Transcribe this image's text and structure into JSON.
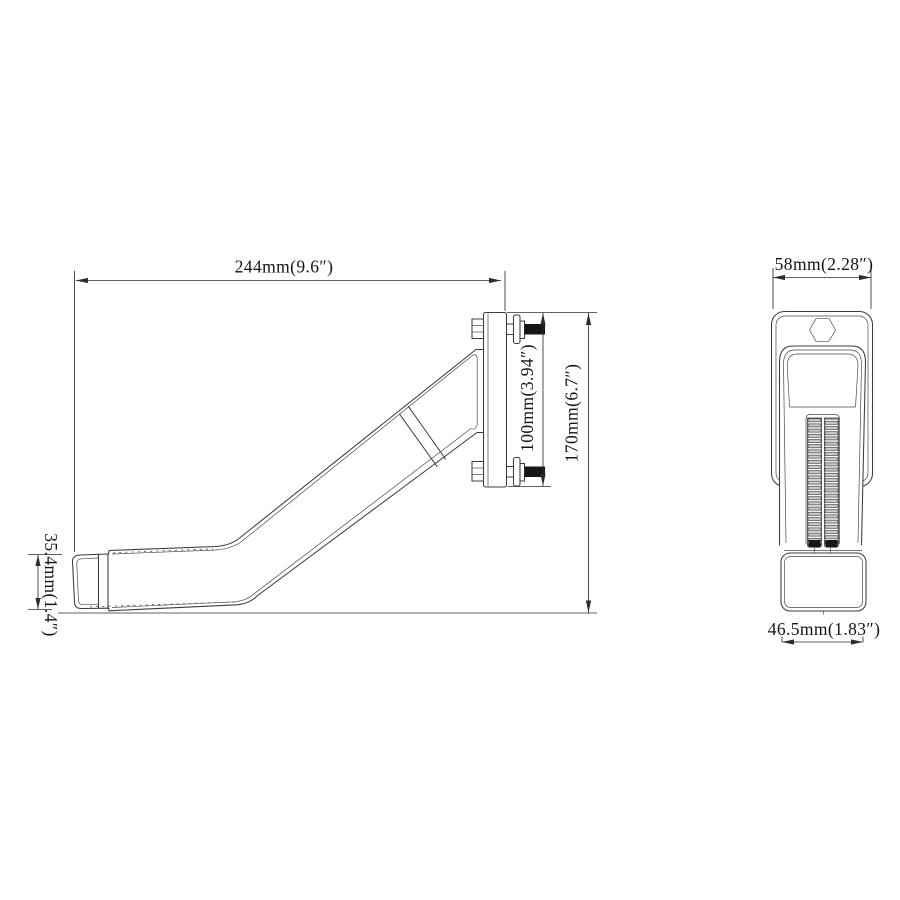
{
  "drawing": {
    "colors": {
      "background": "#ffffff",
      "part_line": "#3c3c3c",
      "dimension_line": "#2d2d2d",
      "text": "#141414",
      "thread_fill": "#161616",
      "rib_fill": "#cccccc"
    },
    "side_view": {
      "overall_width": "244mm(9.6″)",
      "bracket_height": "100mm(3.94″)",
      "overall_height": "170mm(6.7″)",
      "arm_end_height": "35.4mm(1.4″)"
    },
    "front_view": {
      "top_width": "58mm(2.28″)",
      "bottom_width": "46.5mm(1.83″)"
    }
  }
}
